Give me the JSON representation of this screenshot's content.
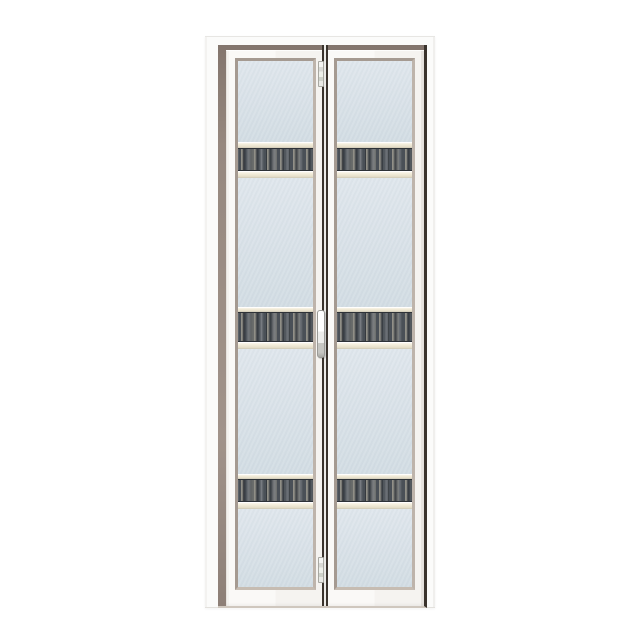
{
  "scene": {
    "kind": "product-photo",
    "subject": "White aluminium bi-fold door with frosted glass panels and three dark wood-grain accent strips per leaf",
    "background_color": "#ffffff",
    "door": {
      "leaf_count": 2,
      "glass_segments_per_leaf": 4,
      "accent_strips_per_leaf": 3,
      "hardware": {
        "top_hinge": "top pivot hinge",
        "bottom_hinge": "bottom pivot hinge",
        "handle": "center pull handle"
      }
    },
    "colors": {
      "background": "#ffffff",
      "frame_white": "#fbfbfa",
      "reveal_taupe": "#96887f",
      "leaf_white": "#faf9f7",
      "glazing_bead": "#b0a59c",
      "glass_light": "#e0e7ed",
      "glass_dark": "#d3dde4",
      "rail_cream": "#f1ebd8",
      "strip_dark": "#4a5057",
      "strip_edge": "#2e3237",
      "gap_dark": "#3a332d"
    }
  },
  "labels": {
    "door_frame": "white aluminium door frame",
    "door_reveal": "taupe frame reveal",
    "left_leaf": "left folding leaf",
    "right_leaf": "right folding leaf",
    "glass_panel": "frosted glass panel",
    "accent_strip": "dark wood-grain accent strip",
    "cream_rail": "cream aluminium rail",
    "center_gap": "meeting gap between leaves",
    "top_hinge": "top hinge",
    "bottom_hinge": "bottom hinge",
    "handle": "pull handle"
  }
}
